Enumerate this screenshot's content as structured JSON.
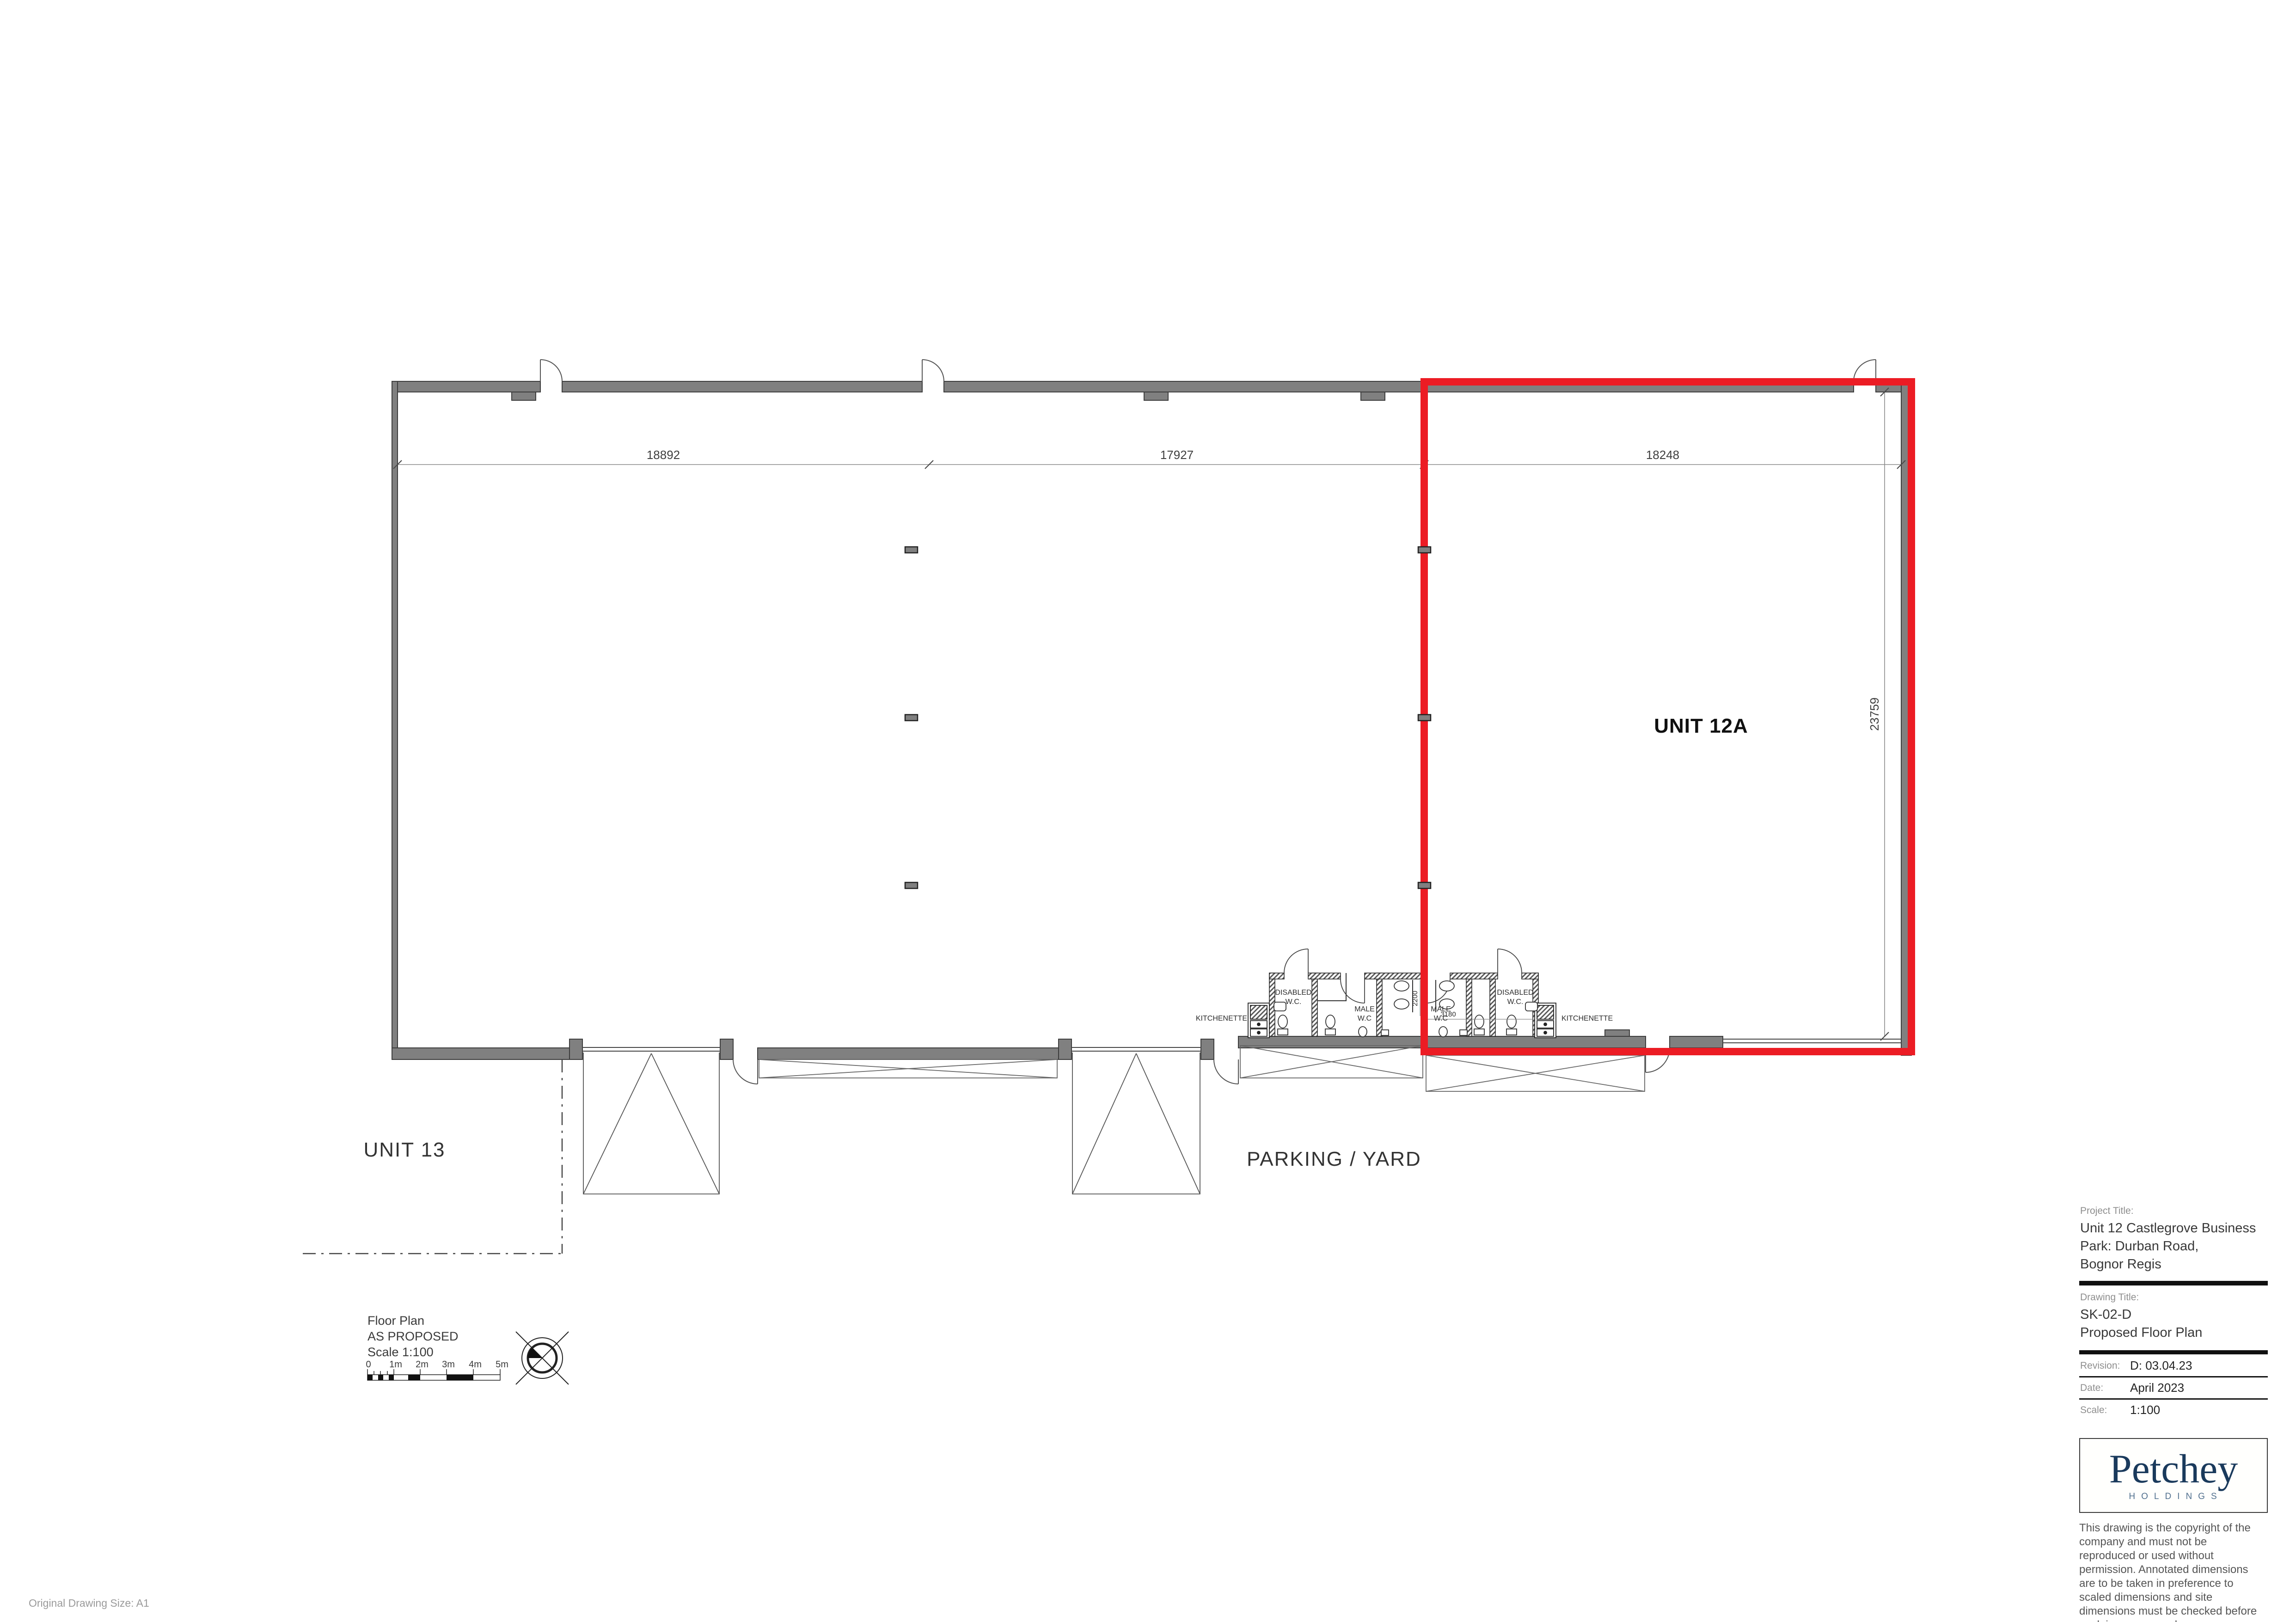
{
  "drawing": {
    "labels": {
      "unit12a": "UNIT 12A",
      "unit13": "UNIT 13",
      "parking": "PARKING / YARD"
    },
    "dimensions": {
      "top_left": "18892",
      "top_middle": "17927",
      "top_right": "18248",
      "right_side": "23759",
      "wc_depth": "2200",
      "wc_width": "3180"
    },
    "wc": {
      "kitchenette_left": "KITCHENETTE",
      "kitchenette_right": "KITCHENETTE",
      "disabled_line1": "DISABLED",
      "disabled_line2": "W.C.",
      "male_line1": "MALE",
      "male_line2": "W.C"
    },
    "legend": {
      "title": "Floor Plan",
      "status": "AS PROPOSED",
      "scale": "Scale 1:100",
      "ticks": [
        "0",
        "1m",
        "2m",
        "3m",
        "4m",
        "5m"
      ]
    },
    "note": "Original Drawing Size: A1"
  },
  "title_block": {
    "project_title_label": "Project Title:",
    "project_title_lines": [
      "Unit 12 Castlegrove Business",
      "Park: Durban Road,",
      "Bognor Regis"
    ],
    "drawing_title_label": "Drawing Title:",
    "drawing_title_lines": [
      "SK-02-D",
      "Proposed Floor Plan"
    ],
    "revision_label": "Revision:",
    "revision_value": "D: 03.04.23",
    "date_label": "Date:",
    "date_value": "April 2023",
    "scale_label": "Scale:",
    "scale_value": "1:100",
    "logo_name": "Petchey",
    "logo_subtitle": "HOLDINGS",
    "disclaimer_lines": [
      "This drawing is the copyright of the company and must not be",
      "reproduced or used without permission. Annotated dimensions",
      "are to be taken in preference to scaled dimensions and site",
      "dimensions must be checked before work is commenced"
    ]
  },
  "colors": {
    "wall_fill": "#808080",
    "wall_outline": "#3d3d3d",
    "highlight_red": "#ec1c24",
    "brand_navy": "#1a3a5c"
  }
}
